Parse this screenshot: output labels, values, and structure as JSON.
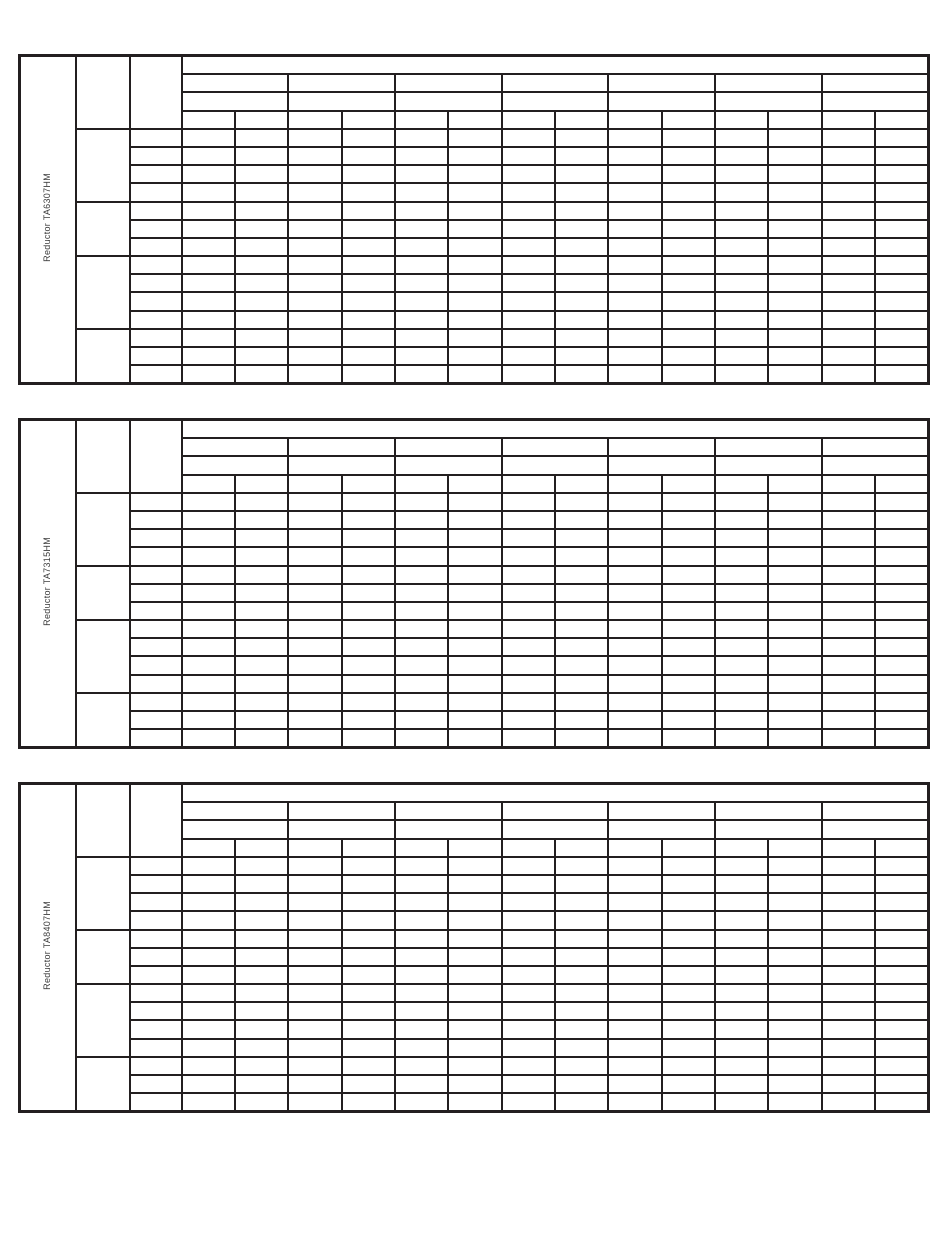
{
  "document": {
    "kind": "blank specification tables page",
    "background_color": "#ffffff",
    "border_color": "#231f20",
    "label_text_color": "#3d3d3d"
  },
  "tables": [
    {
      "label": "Reductor TA6307HM"
    },
    {
      "label": "Reductor TA7315HM"
    },
    {
      "label": "Reductor TA8407HM"
    }
  ],
  "table_structure": {
    "header_rows": 4,
    "header_pair_cells_per_row": 7,
    "data_columns": 14,
    "body_rows": 14,
    "body_row_groups": [
      4,
      3,
      4,
      3
    ],
    "all_cells_empty": true,
    "left_column_widths_px": {
      "label_col": 56,
      "group_col": 54,
      "row_label_col": 52
    }
  }
}
